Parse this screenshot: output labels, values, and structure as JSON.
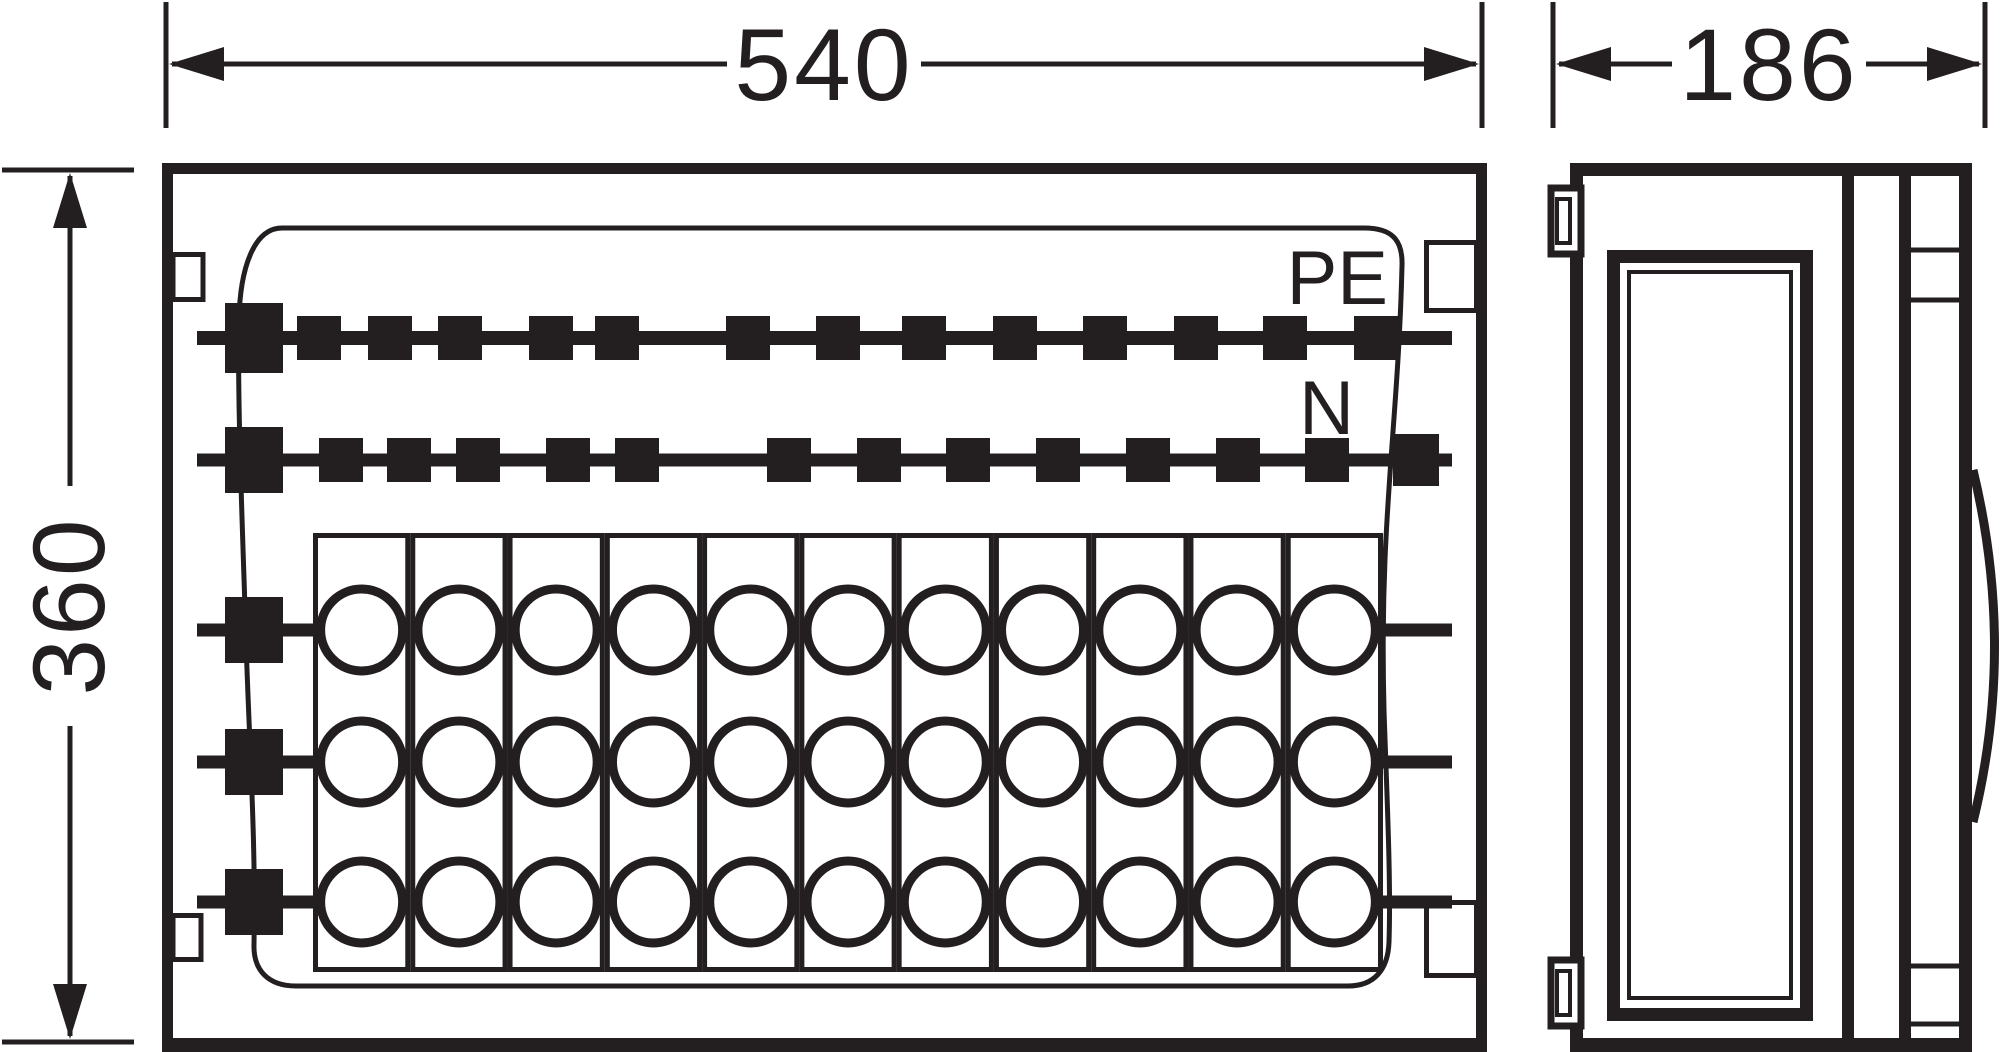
{
  "colors": {
    "ink": "#231f20",
    "paper": "#ffffff"
  },
  "dimensions": {
    "front_width": {
      "label": "540"
    },
    "front_height": {
      "label": "360"
    },
    "side_width": {
      "label": "186"
    }
  },
  "front_view": {
    "pe_busbar": {
      "label": "PE",
      "bar_y": 338,
      "clip_size": 44,
      "clip_centers_x": [
        319,
        390,
        460,
        551,
        617,
        748,
        838,
        924,
        1015,
        1105,
        1196,
        1285,
        1376
      ]
    },
    "n_busbar": {
      "label": "N",
      "bar_y": 460,
      "clip_size": 44,
      "clip_centers_x": [
        341,
        409,
        478,
        568,
        637,
        789,
        879,
        968,
        1058,
        1148,
        1238,
        1327
      ],
      "end_block": {
        "cx": 1416,
        "cy": 460,
        "w": 46,
        "h": 52
      }
    },
    "terminal_block": {
      "columns": 11,
      "rows": 3,
      "left_x": 313,
      "right_x": 1383,
      "top_y": 533,
      "bottom_y": 972,
      "row_centers_y": [
        630,
        762,
        902
      ],
      "circle_radius": 41
    }
  }
}
